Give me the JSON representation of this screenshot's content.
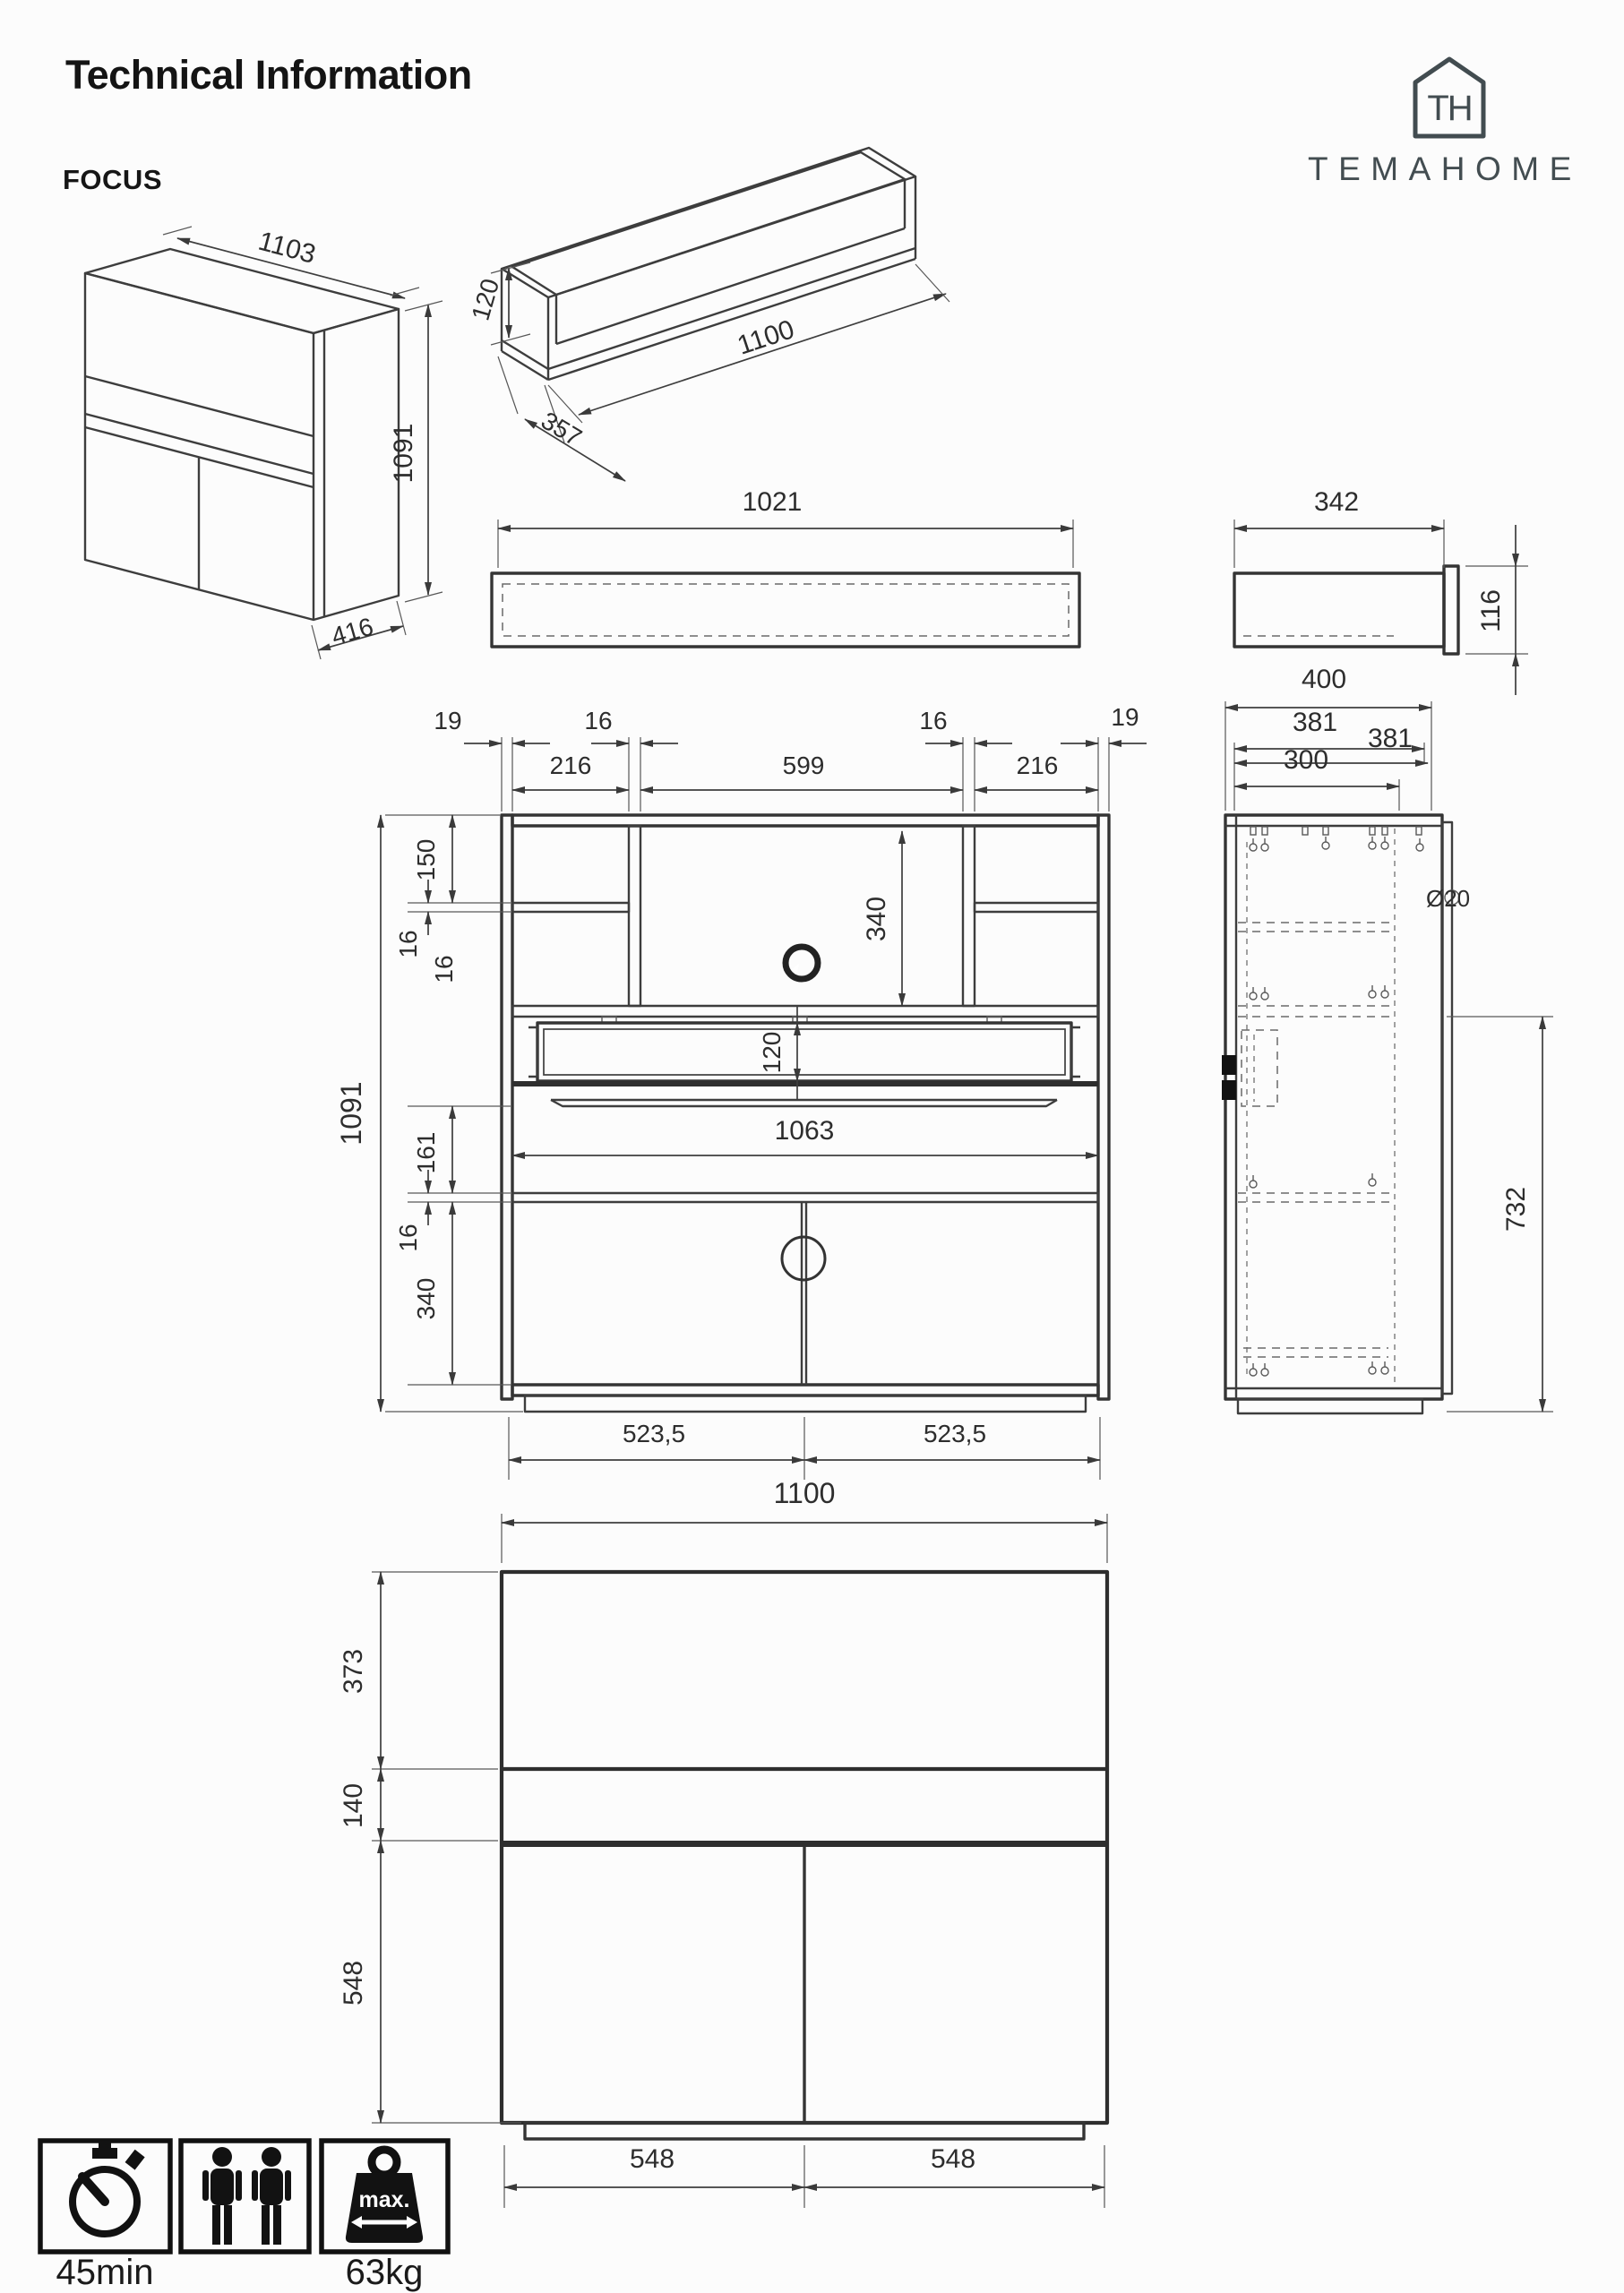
{
  "header": {
    "title": "Technical Information",
    "product": "FOCUS",
    "brand": "TEMAHOME",
    "brand_monogram": "TH"
  },
  "iso_cabinet": {
    "width": "1103",
    "height": "1091",
    "depth": "416"
  },
  "iso_drawer": {
    "height": "120",
    "length": "1100",
    "depth": "357"
  },
  "shelf_front": {
    "width": "1021"
  },
  "shelf_side": {
    "width": "342",
    "height": "116"
  },
  "front_detail": {
    "top": {
      "d19l": "19",
      "d216l": "216",
      "d16l": "16",
      "d599": "599",
      "d16r": "16",
      "d216r": "216",
      "d19r": "19"
    },
    "left": {
      "d150": "150",
      "d16a": "16",
      "d16b": "16",
      "d1091": "1091",
      "d161": "161",
      "d16c": "16",
      "d340": "340"
    },
    "inner": {
      "d340": "340",
      "d120": "120",
      "d1063": "1063"
    },
    "bottom": {
      "left": "523,5",
      "right": "523,5"
    }
  },
  "side_section": {
    "d400": "400",
    "d381a": "381",
    "d381b": "381",
    "d300": "300",
    "d732": "732",
    "hole": "Ø20"
  },
  "front_simple": {
    "width": "1100",
    "d373": "373",
    "d140": "140",
    "d548v": "548",
    "d548l": "548",
    "d548r": "548"
  },
  "badges": {
    "assembly_time": "45min",
    "max_label": "max.",
    "max_weight": "63kg"
  }
}
